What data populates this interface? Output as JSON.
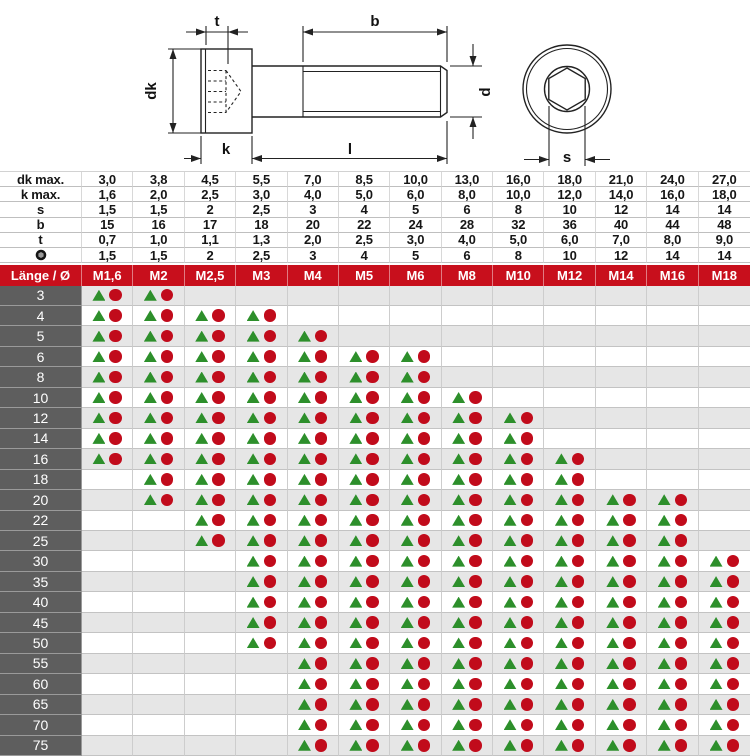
{
  "colors": {
    "header_red": "#c80f1c",
    "label_gray": "#5e5e5e",
    "row_gray": "#e6e6e6",
    "triangle_green": "#2d8f2b",
    "circle_red": "#c10b1b"
  },
  "drawing": {
    "labels": {
      "t": "t",
      "b": "b",
      "dk": "dk",
      "k": "k",
      "l": "l",
      "d": "d",
      "s": "s"
    }
  },
  "spec_table": {
    "rows": [
      {
        "label": "dk max.",
        "values": [
          "3,0",
          "3,8",
          "4,5",
          "5,5",
          "7,0",
          "8,5",
          "10,0",
          "13,0",
          "16,0",
          "18,0",
          "21,0",
          "24,0",
          "27,0"
        ]
      },
      {
        "label": "k max.",
        "values": [
          "1,6",
          "2,0",
          "2,5",
          "3,0",
          "4,0",
          "5,0",
          "6,0",
          "8,0",
          "10,0",
          "12,0",
          "14,0",
          "16,0",
          "18,0"
        ]
      },
      {
        "label": "s",
        "values": [
          "1,5",
          "1,5",
          "2",
          "2,5",
          "3",
          "4",
          "5",
          "6",
          "8",
          "10",
          "12",
          "14",
          "14"
        ]
      },
      {
        "label": "b",
        "values": [
          "15",
          "16",
          "17",
          "18",
          "20",
          "22",
          "24",
          "28",
          "32",
          "36",
          "40",
          "44",
          "48"
        ]
      },
      {
        "label": "t",
        "values": [
          "0,7",
          "1,0",
          "1,1",
          "1,3",
          "2,0",
          "2,5",
          "3,0",
          "4,0",
          "5,0",
          "6,0",
          "7,0",
          "8,0",
          "9,0"
        ]
      },
      {
        "label": "",
        "icon": "hex-socket",
        "values": [
          "1,5",
          "1,5",
          "2",
          "2,5",
          "3",
          "4",
          "5",
          "6",
          "8",
          "10",
          "12",
          "14",
          "14"
        ]
      }
    ]
  },
  "matrix": {
    "corner_label": "Länge / Ø",
    "columns": [
      "M1,6",
      "M2",
      "M2,5",
      "M3",
      "M4",
      "M5",
      "M6",
      "M8",
      "M10",
      "M12",
      "M14",
      "M16",
      "M18"
    ],
    "rows": [
      {
        "length": "3",
        "from": "M1,6",
        "to": "M2"
      },
      {
        "length": "4",
        "from": "M1,6",
        "to": "M3"
      },
      {
        "length": "5",
        "from": "M1,6",
        "to": "M4"
      },
      {
        "length": "6",
        "from": "M1,6",
        "to": "M6"
      },
      {
        "length": "8",
        "from": "M1,6",
        "to": "M6"
      },
      {
        "length": "10",
        "from": "M1,6",
        "to": "M8"
      },
      {
        "length": "12",
        "from": "M1,6",
        "to": "M10"
      },
      {
        "length": "14",
        "from": "M1,6",
        "to": "M10"
      },
      {
        "length": "16",
        "from": "M1,6",
        "to": "M12"
      },
      {
        "length": "18",
        "from": "M2",
        "to": "M12"
      },
      {
        "length": "20",
        "from": "M2",
        "to": "M16"
      },
      {
        "length": "22",
        "from": "M2,5",
        "to": "M16"
      },
      {
        "length": "25",
        "from": "M2,5",
        "to": "M16"
      },
      {
        "length": "30",
        "from": "M3",
        "to": "M18"
      },
      {
        "length": "35",
        "from": "M3",
        "to": "M18"
      },
      {
        "length": "40",
        "from": "M3",
        "to": "M18"
      },
      {
        "length": "45",
        "from": "M3",
        "to": "M18"
      },
      {
        "length": "50",
        "from": "M3",
        "to": "M18"
      },
      {
        "length": "55",
        "from": "M4",
        "to": "M18"
      },
      {
        "length": "60",
        "from": "M4",
        "to": "M18"
      },
      {
        "length": "65",
        "from": "M4",
        "to": "M18"
      },
      {
        "length": "70",
        "from": "M4",
        "to": "M18"
      },
      {
        "length": "75",
        "from": "M4",
        "to": "M18"
      }
    ]
  }
}
